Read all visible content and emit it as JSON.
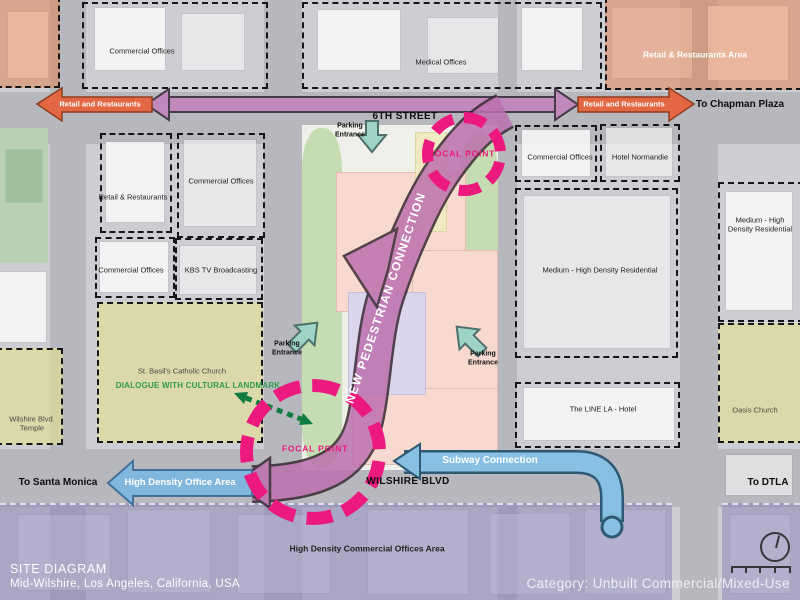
{
  "title_block": {
    "title": "SITE DIAGRAM",
    "location": "Mid-Wilshire, Los Angeles, California, USA",
    "category": "Category: Unbuilt Commercial/Mixed-Use"
  },
  "streets": {
    "sixth": "6TH STREET",
    "wilshire": "WILSHIRE BLVD"
  },
  "directions": {
    "chapman": "To Chapman Plaza",
    "santa_monica": "To Santa Monica",
    "dtla": "To DTLA"
  },
  "flow_arrows": {
    "retail_left": "Retail and Restaurants",
    "retail_right": "Retail and Restaurants",
    "office": "High Density Office Area",
    "subway": "Subway Connection",
    "pedestrian": "NEW PEDESTRIAN CONNECTION"
  },
  "annotations": {
    "focal_top": "FOCAL POINT",
    "focal_bottom": "FOCAL POINT",
    "dialogue": "DIALOGUE WITH CULTURAL LANDMARK",
    "parking_line1": "Parking",
    "parking_line2": "Entrance"
  },
  "zones": {
    "commercial_top": "Commercial Offices",
    "medical": "Medical Offices",
    "retail_area": "Retail & Restaurants Area",
    "retail_mid": "Retail & Restaurants",
    "commercial_mid": "Commercial Offices",
    "commercial_low": "Commercial Offices",
    "kbs": "KBS TV Broadcasting",
    "commercial_right": "Commercial Offices",
    "hotel_normandie": "Hotel Normandie",
    "residential_main": "Medium - High Density Residential",
    "residential_east_l1": "Medium - High",
    "residential_east_l2": "Density Residential",
    "line_hotel": "The LINE LA - Hotel",
    "st_basil": "St. Basil's Catholic Church",
    "temple_l1": "Wilshire Blvd.",
    "temple_l2": "Temple",
    "oasis": "Oasis Church",
    "high_density_commercial": "High Density Commercial Offices Area"
  },
  "colors": {
    "pedestrian_pink": "#bc6fae",
    "focal_magenta": "#ec1a7e",
    "retail_orange": "#e36742",
    "flow_blue": "#87c0e2",
    "parking_teal": "#9ed3c8",
    "dialogue_green": "#0e7c3e",
    "zone_orange": "#e28558",
    "zone_yellow": "#e3de92",
    "zone_purple": "#847eb6"
  }
}
